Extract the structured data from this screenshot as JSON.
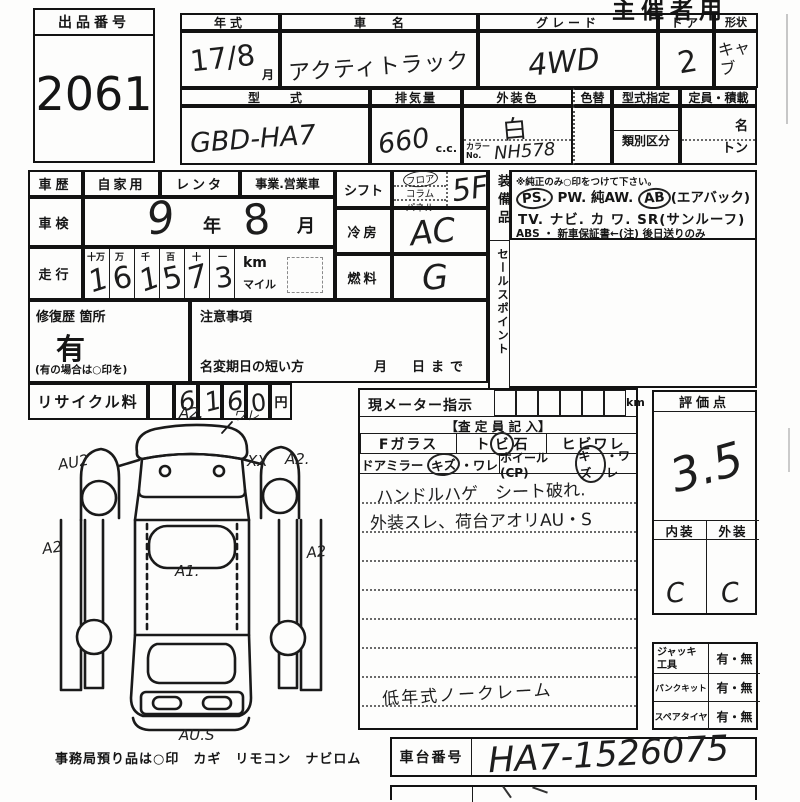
{
  "sheet": {
    "corner_note": "主催者用",
    "exhibit": {
      "label": "出品番号",
      "value": "2061"
    },
    "header": {
      "year_label": "年式",
      "year_value": "17/8",
      "month_unit": "月",
      "name_label": "車名",
      "name_value": "アクティトラック",
      "grade_label": "グレード",
      "grade_value": "4WD",
      "door_label": "ドア",
      "door_value": "2",
      "shape_label": "形状",
      "shape_value": "キャブ",
      "model_label": "型式",
      "model_value": "GBD-HA7",
      "disp_label": "排気量",
      "disp_value": "660",
      "disp_unit": "c.c.",
      "color_label": "外装色",
      "color_value": "白",
      "color_no_label": "カラーNo.",
      "color_no_value": "NH578",
      "repaint_label": "色替",
      "type_desig_label": "型式指定",
      "class_label": "類別区分",
      "capacity_label": "定員・積載",
      "persons_unit": "名",
      "tons_unit": "トン"
    },
    "history": {
      "label": "車歴",
      "options": [
        "自家用",
        "レンタ",
        "事業.営業車"
      ]
    },
    "inspection": {
      "label": "車検",
      "year": "9",
      "year_unit": "年",
      "month": "8",
      "month_unit": "月"
    },
    "mileage": {
      "label": "走行",
      "place_headers": [
        "十万",
        "万",
        "千",
        "百",
        "十",
        "一"
      ],
      "digits": [
        "1",
        "6",
        "1",
        "5",
        "7",
        "3"
      ],
      "km": "km",
      "mile": "マイル"
    },
    "shift": {
      "label": "シフト",
      "options": [
        "フロア",
        "コラム",
        "パネル"
      ],
      "value": "5F"
    },
    "aircon": {
      "label": "冷房",
      "value": "AC"
    },
    "fuel": {
      "label": "燃料",
      "value": "G"
    },
    "equipment": {
      "label": "装備品",
      "note": "※純正のみ○印をつけて下さい。",
      "ps": "PS.",
      "mid1": "PW. 純AW.",
      "ab": "AB",
      "ab_suffix": "(エアバック)",
      "line2": "TV. ナビ. カ ワ. SR(サンルーフ)",
      "line3": "ABS ・ 新車保証書←(注) 後日送りのみ"
    },
    "sales_point": {
      "label": "セールスポイント"
    },
    "repair": {
      "label": "修復歴 箇所",
      "value": "有",
      "note": "(有の場合は○印を)"
    },
    "caution": {
      "label": "注意事項",
      "name_change": "名変期日の短い方",
      "date_until": "月　日まで"
    },
    "recycle": {
      "label": "リサイクル料",
      "digits": [
        "6",
        "1",
        "6",
        "0"
      ],
      "unit": "円"
    },
    "meter": {
      "label": "現メーター指示",
      "unit": "km"
    },
    "assessor": {
      "header": "【査 定 員 記 入】",
      "f_glass": "Fガラス",
      "stone_pre": "ト",
      "stone_circled": "ビ",
      "stone_post": "石",
      "crack": "ヒビワレ",
      "mirror_label": "ドアミラー",
      "mirror_circled": "キズ",
      "mirror_rest": "・ワレ",
      "wheel_label": "ホイール(CP)",
      "wheel_circled": "キズ",
      "wheel_rest": "・ワレ",
      "notes": [
        "ハンドルハゲ　シート破れ.",
        "外装スレ、荷台アオリAU・S",
        "低年式ノークレーム"
      ]
    },
    "evaluation": {
      "label": "評価点",
      "score": "3.5",
      "interior_label": "内装",
      "exterior_label": "外装",
      "interior": "C",
      "exterior": "C"
    },
    "accessories": {
      "items": [
        {
          "label": "ジャッキ 工具",
          "value": "有・無"
        },
        {
          "label": "パンクキット",
          "value": "有・無"
        },
        {
          "label": "スペアタイヤ",
          "value": "有・無"
        }
      ]
    },
    "chassis": {
      "label": "車台番号",
      "value": "HA7-1526075"
    },
    "office_note": "事務局預り品は○印　カギ　リモコン　ナビロム",
    "diagram": {
      "marks": [
        "A2.",
        "ワレ",
        "AU2",
        "XX",
        "A2.",
        "A2",
        "A2",
        "A1.",
        "AU.S"
      ]
    }
  }
}
